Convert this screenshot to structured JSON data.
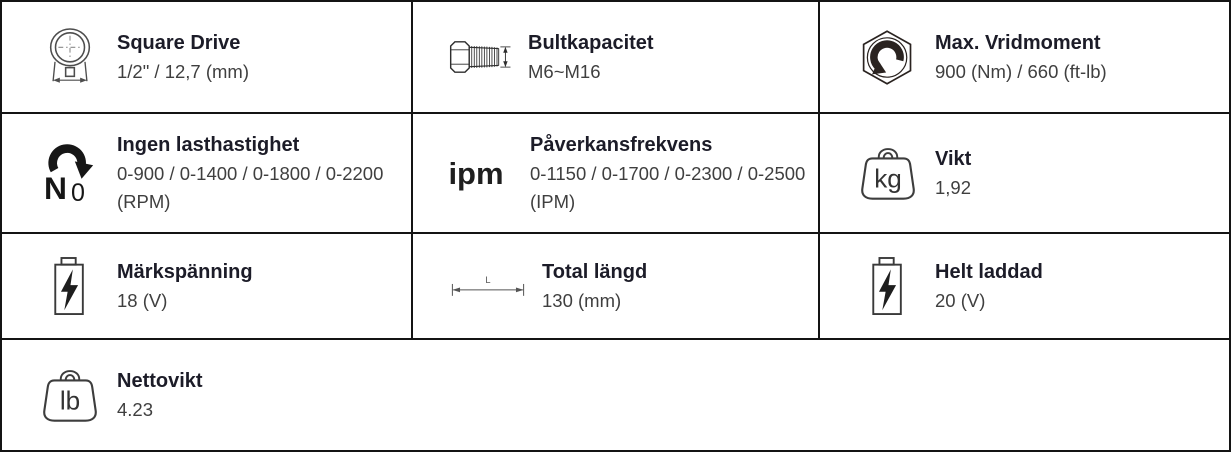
{
  "spec": {
    "square_drive": {
      "label": "Square Drive",
      "value": "1/2\" / 12,7 (mm)"
    },
    "bolt_capacity": {
      "label": "Bultkapacitet",
      "value": "M6~M16"
    },
    "max_torque": {
      "label": "Max. Vridmoment",
      "value": "900 (Nm) / 660 (ft-lb)"
    },
    "no_load_speed": {
      "label": "Ingen lasthastighet",
      "value": "0-900 / 0-1400 / 0-1800 / 0-2200 (RPM)"
    },
    "impact_rate": {
      "label": "Påverkansfrekvens",
      "value": "0-1150 / 0-1700 / 0-2300 / 0-2500 (IPM)"
    },
    "weight": {
      "label": "Vikt",
      "value": "1,92"
    },
    "rated_voltage": {
      "label": "Märkspänning",
      "value": "18 (V)"
    },
    "total_length": {
      "label": "Total längd",
      "value": "130 (mm)"
    },
    "fully_charged": {
      "label": "Helt laddad",
      "value": "20 (V)"
    },
    "net_weight": {
      "label": "Nettovikt",
      "value": "4.23"
    }
  },
  "icons": {
    "ipm_text": "ipm",
    "no_load_n": "N",
    "no_load_sub": "0",
    "kg_text": "kg",
    "lb_text": "lb",
    "length_text": "L"
  },
  "colors": {
    "border": "#141414",
    "heading_text": "#1c1c28",
    "value_text": "#3f3f3f",
    "background": "#ffffff"
  }
}
